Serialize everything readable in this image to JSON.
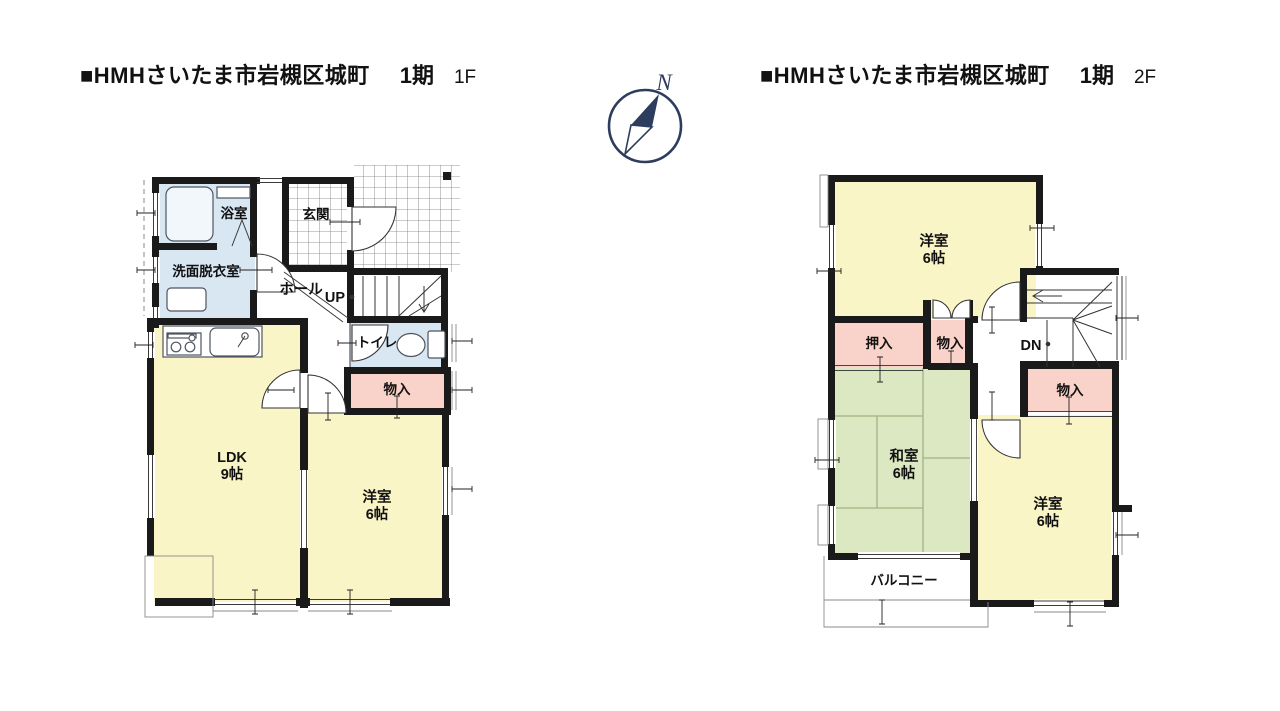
{
  "compass": {
    "label": "N",
    "color": "#2d3d5e"
  },
  "colors": {
    "wall": "#1a1a1a",
    "room_yellow": "#faf5c6",
    "room_pink": "#f9d3c9",
    "room_blue": "#d9e7f3",
    "tatami_green": "#dce8c2",
    "grid_line": "#777777",
    "compass_navy": "#2d3d5e"
  },
  "floors": [
    {
      "title": {
        "project": "■HMHさいたま市岩槻区城町",
        "phase": "1期",
        "floor": "1F"
      },
      "rooms": {
        "bath": "浴室",
        "washroom": "洗面脱衣室",
        "entrance": "玄関",
        "hall": "ホール",
        "stairs_up": "UP",
        "toilet": "トイレ",
        "storage": "物入",
        "ldk_name": "LDK",
        "ldk_size": "9帖",
        "western_name": "洋室",
        "western_size": "6帖"
      }
    },
    {
      "title": {
        "project": "■HMHさいたま市岩槻区城町",
        "phase": "1期",
        "floor": "2F"
      },
      "rooms": {
        "western1_name": "洋室",
        "western1_size": "6帖",
        "stairs_down": "DN",
        "closet": "押入",
        "storage_mid": "物入",
        "storage_right": "物入",
        "japanese_name": "和室",
        "japanese_size": "6帖",
        "western2_name": "洋室",
        "western2_size": "6帖",
        "balcony": "バルコニー"
      }
    }
  ]
}
